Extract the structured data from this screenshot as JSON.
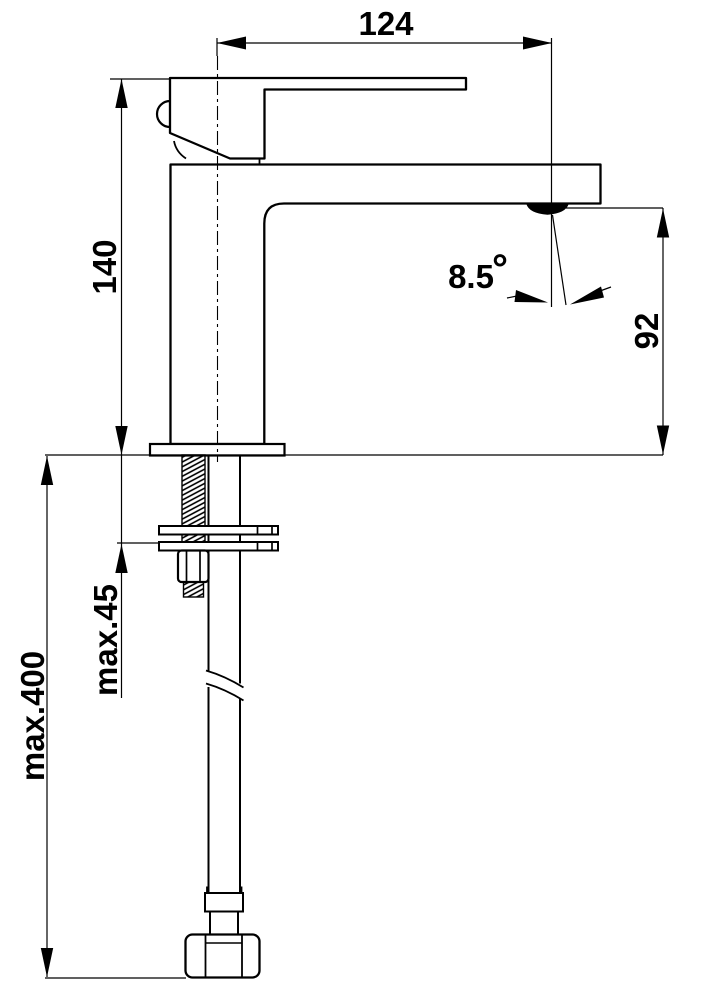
{
  "drawing_type": "faucet-installation-dimension-drawing",
  "colors": {
    "line": "#000000",
    "background": "#ffffff"
  },
  "dimensions": {
    "spout_reach": "124",
    "fitting_height": "140",
    "outlet_height": "92",
    "spout_angle_value": "8.5",
    "spout_angle_unit": "°",
    "max_mounting_thickness": "max.45",
    "max_hose_length": "max.400"
  }
}
